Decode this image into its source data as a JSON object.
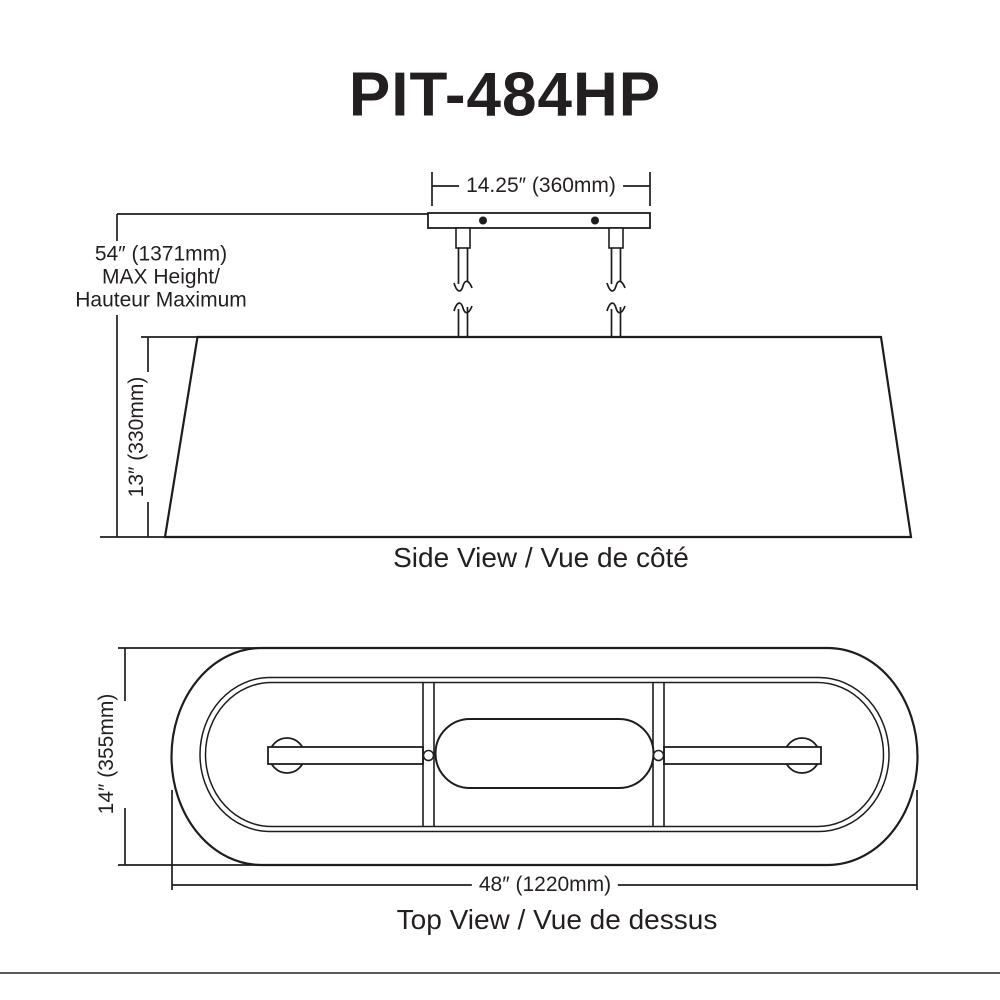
{
  "title": "PIT-484HP",
  "colors": {
    "line": "#1d1d1b",
    "text": "#231f20",
    "divider": "#58595b",
    "background": "#ffffff"
  },
  "side_view": {
    "caption": "Side View / Vue de côté",
    "canopy_width_dim": "14.25″ (360mm)",
    "shade_height_dim": "13″ (330mm)",
    "max_height": {
      "line1": "54″ (1371mm)",
      "line2": "MAX Height/",
      "line3": "Hauteur Maximum"
    }
  },
  "top_view": {
    "caption": "Top View / Vue de dessus",
    "width_dim": "14″ (355mm)",
    "length_dim": "48″ (1220mm)"
  }
}
